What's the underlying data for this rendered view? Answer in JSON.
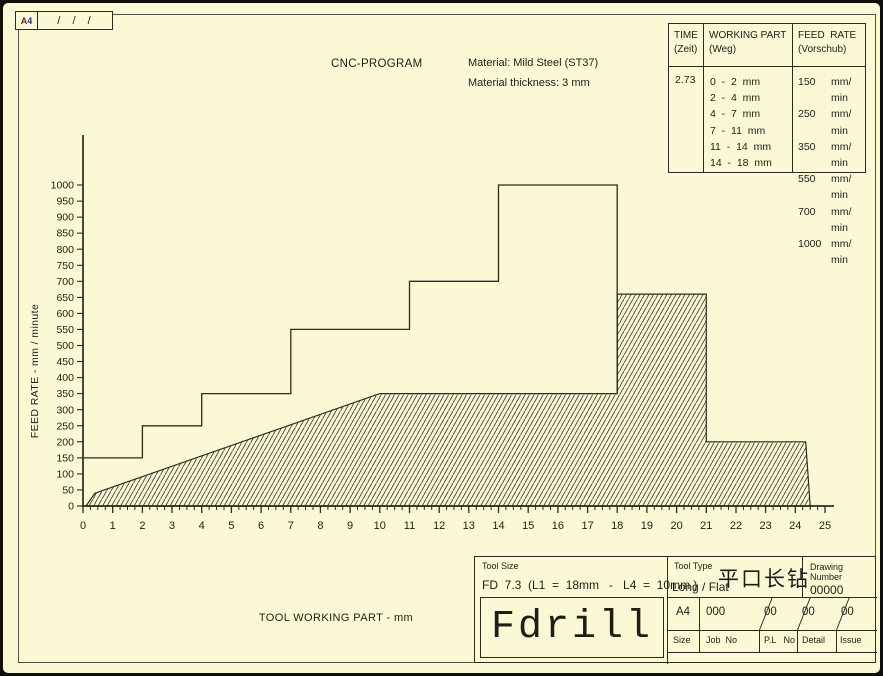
{
  "colors": {
    "paper": "#fbf8d6",
    "ink": "#1e1e16",
    "line": "#2c2b1f",
    "hatch": "#3f3d2f"
  },
  "sheet_marks": {
    "format": "A4",
    "format_letter": "A",
    "format_digit": "4",
    "revision_slashes": "/  /  /"
  },
  "header": {
    "material_line1": "Material: Mild Steel (ST37)",
    "material_line2": "Material thickness: 3 mm"
  },
  "feed_table": {
    "headers": {
      "time_1": "TIME",
      "time_2": "(Zeit)",
      "part_1": "WORKING PART",
      "part_2": "(Weg)",
      "rate_1": "FEED  RATE",
      "rate_2": "(Vorschub)"
    },
    "time_value": "2.73",
    "rows": [
      {
        "part": "0  -  2  mm",
        "rate": "150",
        "unit": "mm/ min"
      },
      {
        "part": "2  -  4  mm",
        "rate": "250",
        "unit": "mm/ min"
      },
      {
        "part": "4  -  7  mm",
        "rate": "350",
        "unit": "mm/ min"
      },
      {
        "part": "7  -  11  mm",
        "rate": "550",
        "unit": "mm/ min"
      },
      {
        "part": "11  -  14  mm",
        "rate": "700",
        "unit": "mm/ min"
      },
      {
        "part": "14  -  18  mm",
        "rate": "1000",
        "unit": "mm/ min"
      }
    ]
  },
  "chart_data": {
    "type": "line",
    "title": "CNC-PROGRAM",
    "xlabel": "TOOL WORKING PART  -  mm",
    "ylabel": "FEED  RATE  -  mm / minute",
    "xlim": [
      0,
      25
    ],
    "ylim": [
      0,
      1000
    ],
    "grid": false,
    "x_ticks": {
      "min": 0,
      "max": 25,
      "step": 1,
      "minor_step": 0.25
    },
    "y_ticks": {
      "min": 0,
      "max": 1000,
      "step": 50
    },
    "series": [
      {
        "name": "programmed feed rate steps",
        "style": "step-line",
        "points": [
          [
            0,
            150
          ],
          [
            2,
            150
          ],
          [
            2,
            250
          ],
          [
            4,
            250
          ],
          [
            4,
            350
          ],
          [
            7,
            350
          ],
          [
            7,
            550
          ],
          [
            11,
            550
          ],
          [
            11,
            700
          ],
          [
            14,
            700
          ],
          [
            14,
            1000
          ],
          [
            18,
            1000
          ],
          [
            18,
            350
          ]
        ]
      },
      {
        "name": "tool working profile (hatched)",
        "style": "hatched-area",
        "points": [
          [
            0.1,
            0
          ],
          [
            0.4,
            40
          ],
          [
            10,
            350
          ],
          [
            18,
            350
          ],
          [
            18,
            660
          ],
          [
            21,
            660
          ],
          [
            21,
            200
          ],
          [
            24.35,
            200
          ],
          [
            24.5,
            0
          ]
        ]
      }
    ]
  },
  "title_block": {
    "tool_size_label": "Tool Size",
    "tool_size_value": "FD  7.3  (L1  =  18mm   -   L4  =  10mm )",
    "tool_name": "Fdrill",
    "tool_type_label": "Tool Type",
    "tool_type_value": "Long / Flat",
    "tool_type_cn": "平口长钻",
    "drawing_number_label": "Drawing  Number",
    "drawing_number_value": "00000",
    "size_value": "A4",
    "job_no_value": "000",
    "pl_no_value": "00",
    "detail_value": "00",
    "issue_value": "00",
    "size_label": "Size",
    "job_no_label": "Job  No",
    "pl_no_label": "P.L   No",
    "detail_label": "Detail",
    "issue_label": "Issue"
  }
}
